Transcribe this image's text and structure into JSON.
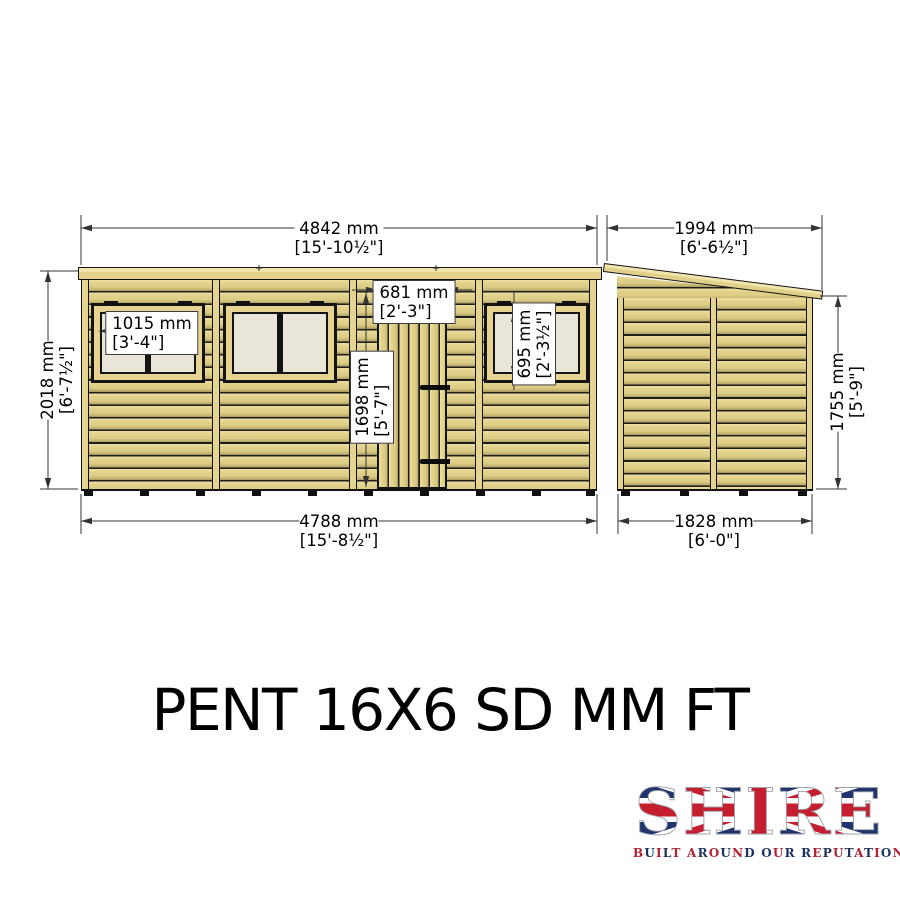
{
  "title": "PENT 16X6 SD MM FT",
  "dimensions": {
    "front_roof_width": {
      "mm": "4842 mm",
      "ftin": "[15'-10½\"]"
    },
    "side_roof_depth": {
      "mm": "1994 mm",
      "ftin": "[6'-6½\"]"
    },
    "front_height": {
      "mm": "2018 mm",
      "ftin": "[6'-7½\"]"
    },
    "side_eaves_height": {
      "mm": "1755 mm",
      "ftin": "[5'-9\"]"
    },
    "front_base_width": {
      "mm": "4788 mm",
      "ftin": "[15'-8½\"]"
    },
    "side_base_depth": {
      "mm": "1828 mm",
      "ftin": "[6'-0\"]"
    },
    "window_width": {
      "mm": "1015 mm",
      "ftin": "[3'-4\"]"
    },
    "door_width": {
      "mm": "681 mm",
      "ftin": "[2'-3\"]"
    },
    "door_height": {
      "mm": "1698 mm",
      "ftin": "[5'-7\"]"
    },
    "window_height": {
      "mm": "695 mm",
      "ftin": "[2'-3½\"]"
    }
  },
  "logo": {
    "name": "SHIRE",
    "tagline": "BUILT AROUND OUR REPUTATION",
    "tagline_colors": [
      "#b22234",
      "#1e3260"
    ],
    "flag_navy": "#21346d",
    "flag_red": "#c41e2f"
  },
  "colors": {
    "wood": "#e7d492",
    "wood_shadow": "#b7a765",
    "glass": "#e9e5d8",
    "drawing_line": "#1a1a1a"
  }
}
